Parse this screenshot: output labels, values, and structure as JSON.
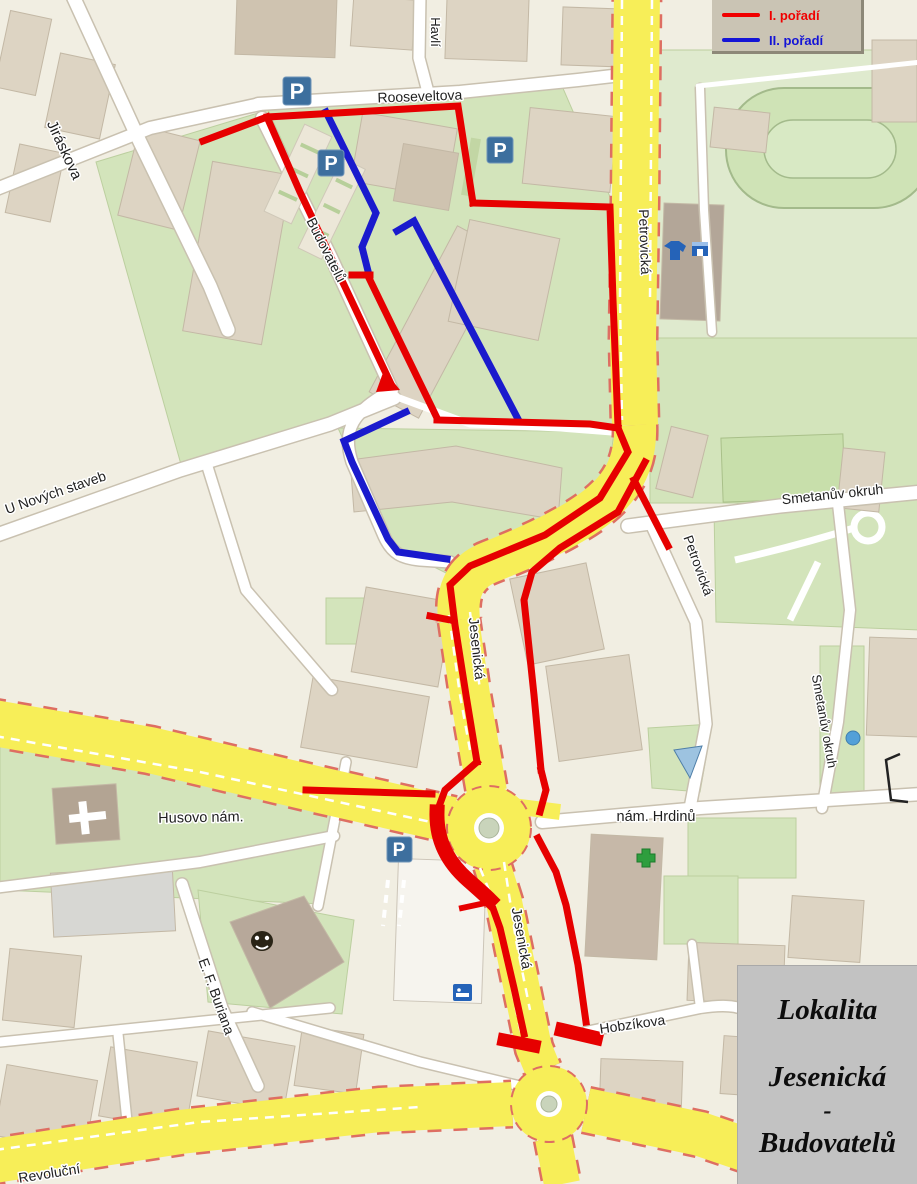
{
  "legend": {
    "items": [
      {
        "label": "I. pořadí",
        "color": "#f00000"
      },
      {
        "label": "II. pořadí",
        "color": "#1414d6"
      }
    ]
  },
  "title_box": {
    "line1": "Lokalita",
    "line2": "Jesenická",
    "line3": "-",
    "line4": "Budovatelů"
  },
  "street_labels": {
    "rooseveltova": "Rooseveltova",
    "havlickova": "Havlí",
    "jiraskova": "Jiráskova",
    "budovatelu": "Budovatelů",
    "petrovicka_top": "Petrovická",
    "petrovicka_mid": "Petrovická",
    "u_novych_staveb": "U Nových staveb",
    "smetanuv_okruh": "Smetanův okruh",
    "smetanuv_okruh_e": "Smetanův okruh",
    "jesenicka_upper": "Jesenická",
    "jesenicka_lower": "Jesenická",
    "husovo_nam": "Husovo nám.",
    "nam_hrdinu": "nám. Hrdinů",
    "ef_buriana": "E. F. Buriana",
    "hobzikova": "Hobzíkova",
    "revolucni": "Revoluční"
  },
  "icons": {
    "parking_letter": "P"
  },
  "map_colors": {
    "background": "#f1eee2",
    "green_area": "#d3e4bb",
    "building": "#ddd4c3",
    "major_road": "#f7ee58",
    "minor_road": "#ffffff",
    "route_primary_red": "#e60000",
    "route_secondary_blue": "#1a1acd"
  }
}
